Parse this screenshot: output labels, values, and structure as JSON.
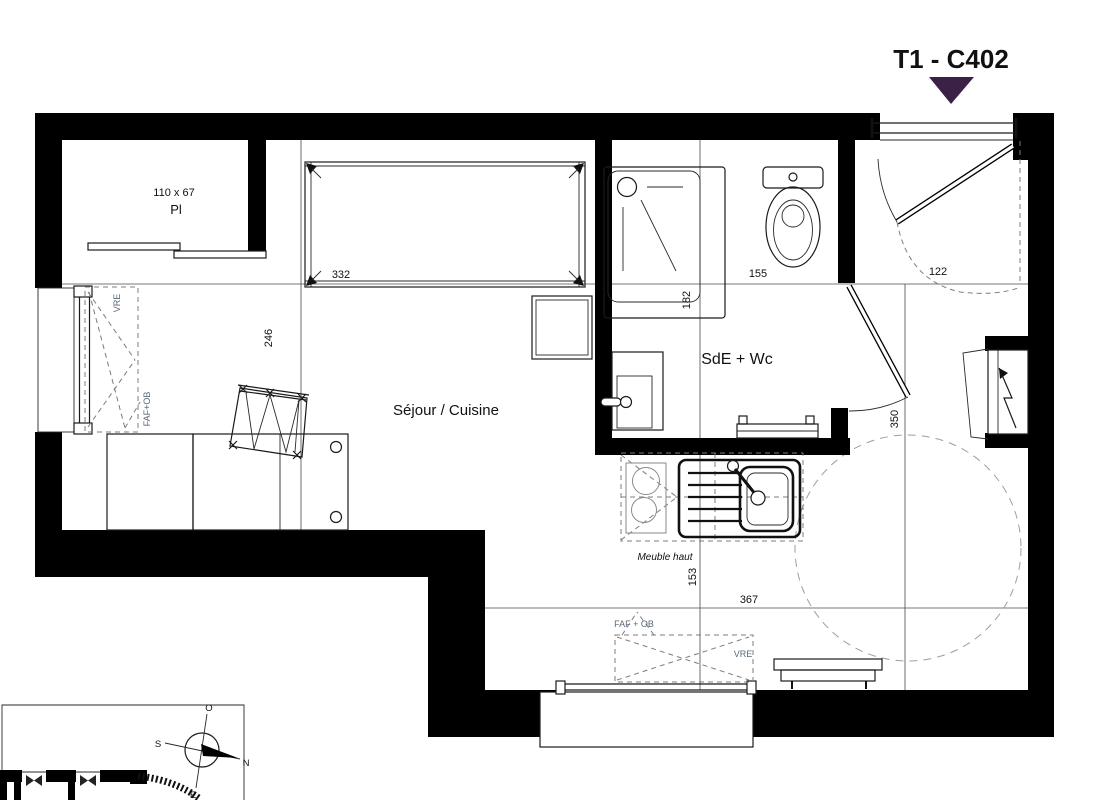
{
  "title": "T1 - C402",
  "rooms": {
    "living": "Séjour / Cuisine",
    "bathroom": "SdE + Wc",
    "closet_abbr": "Pl",
    "closet_size": "110 x 67",
    "upper_cabinet_note": "Meuble haut"
  },
  "dimensions_cm": {
    "living_window_width": "332",
    "bathroom_width": "155",
    "entry_width": "122",
    "living_depth": "246",
    "shower_zone_depth": "182",
    "entry_zone_depth": "350",
    "kitchen_zone_depth": "153",
    "lower_zone_width": "367"
  },
  "window_tags": {
    "left_vre": "VRE",
    "left_faf_ob": "FAF+OB",
    "bottom_faf_ob": "FAF + OB",
    "bottom_vre": "VRE"
  },
  "compass": {
    "north": "N",
    "south": "S",
    "east": "E",
    "west": "O"
  },
  "colors": {
    "title": "#3A2145",
    "walls": "#000000",
    "dash": "#8a8a8a"
  }
}
